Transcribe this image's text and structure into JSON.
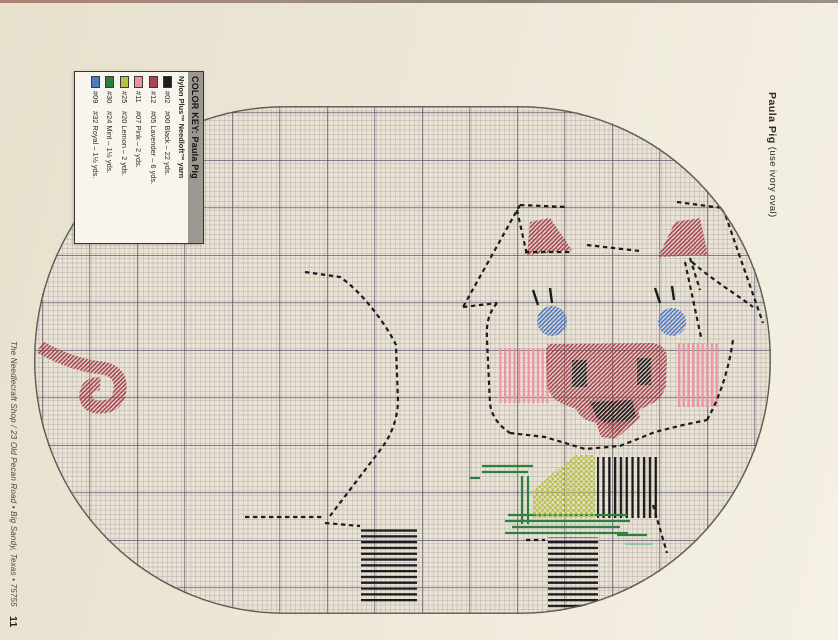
{
  "page": {
    "left_margin": {
      "text": "The Needlecraft Shop / 23 Old Pecan Road • Big Sandy, Texas • 75755",
      "page_number": "11"
    },
    "right_margin": {
      "title": "Paula Pig",
      "subtitle": " (use ivory oval)"
    }
  },
  "color_key": {
    "title_label": "COLOR KEY:",
    "title_name": " Paula Pig",
    "header": "Nylon Plus™ Needloft™ yarn",
    "rows": [
      {
        "swatch": "#1d1d1f",
        "nylon": "#02",
        "needloft": "#00 Black – 22 yds."
      },
      {
        "swatch": "#a84550",
        "nylon": "#12",
        "needloft": "#05 Lavender – 6 yds."
      },
      {
        "swatch": "#ee92a1",
        "nylon": "#11",
        "needloft": "#07 Pink – 2 yds."
      },
      {
        "swatch": "#b9c240",
        "nylon": "#25",
        "needloft": "#20 Lemon – 2 yds."
      },
      {
        "swatch": "#2e8040",
        "nylon": "#30",
        "needloft": "#24 Mint – 1½ yds."
      },
      {
        "swatch": "#4f79c4",
        "nylon": "#09",
        "needloft": "#32 Royal – 1½ yds."
      }
    ]
  },
  "palette": {
    "black": "#1c1c1e",
    "lav": "#a84550",
    "pink": "#ee92a1",
    "royal": "#4f79c4",
    "lemon": "#b9c240",
    "mint": "#2e8040",
    "mintLight": "#93c6a0",
    "paper": "#e9e3d3",
    "gridThin": "#a59aa6",
    "gridBold": "#48415a",
    "outline": "#5f5a52"
  },
  "chart": {
    "oval": {
      "x": 34,
      "y": 106,
      "width": 737,
      "height": 508,
      "rx": 250,
      "ry": 252,
      "cell": 4.75,
      "bold_every": 10
    },
    "patterns": [
      {
        "id": "pLav",
        "type": "diag",
        "color": "lav"
      },
      {
        "id": "pBlue",
        "type": "diag",
        "color": "royal"
      },
      {
        "id": "pBlackDiag",
        "type": "diag",
        "color": "black"
      },
      {
        "id": "pPinkV",
        "type": "vlines",
        "color": "pink",
        "gap": 4.7,
        "w": 2.2
      },
      {
        "id": "pLemon",
        "type": "check",
        "color": "lemon",
        "size": 2.6
      },
      {
        "id": "pBlackH",
        "type": "hlines",
        "color": "black",
        "gap": 5.8,
        "w": 2.3
      },
      {
        "id": "pBlackV",
        "type": "vlines",
        "color": "black",
        "gap": 5.8,
        "w": 2.3
      }
    ],
    "shapes": [
      {
        "kind": "curl",
        "name": "pig-tail",
        "pattern": "pLav",
        "width": 13,
        "d": "M6,241 Q38,259 68,262 Q88,265 86,284 Q84,301 66,301 Q50,301 52,287 Q54,277 66,278"
      },
      {
        "kind": "dash",
        "name": "pig-back-outline",
        "d": "M271,166 L306,171 C328,186 352,218 362,239 L364,296 C363,316 356,331 347,343 L296,410"
      },
      {
        "kind": "dash",
        "name": "pig-belly-outline",
        "d": "M211,411 L291,411 M291,417 L326,420"
      },
      {
        "kind": "rect",
        "name": "back-leg-stitches",
        "pattern": "pBlackH",
        "x": 327,
        "y": 421,
        "w": 56,
        "h": 76
      },
      {
        "kind": "rect",
        "name": "front-leg-stitches",
        "pattern": "pBlackH",
        "x": 514,
        "y": 431,
        "w": 50,
        "h": 74
      },
      {
        "kind": "rect",
        "name": "front-upper-leg-stitches",
        "pattern": "pBlackV",
        "x": 563,
        "y": 351,
        "w": 61,
        "h": 61
      },
      {
        "kind": "stroke",
        "name": "bow-ribbon-mint",
        "color": "mint",
        "width": 2.2,
        "d": "M448,360 L499,360 M448,366 L494,366 M436,372 L446,372 M488,370 L488,418 M494,370 L494,418 M474,409 L593,409 M471,415 L596,415 M478,421 L586,421 M471,427 L594,427 M583,429 L613,429"
      },
      {
        "kind": "stroke",
        "name": "bow-ribbon-mint-light",
        "color": "mintLight",
        "width": 2.2,
        "d": "M591,438 L619,438"
      },
      {
        "kind": "poly",
        "name": "bow-knot-lemon",
        "pattern": "pLemon",
        "points": "499,384 541,349 561,349 561,412 499,412"
      },
      {
        "kind": "rect",
        "name": "cheek-left-pink",
        "pattern": "pPinkV",
        "x": 464,
        "y": 242,
        "w": 52,
        "h": 55
      },
      {
        "kind": "rect",
        "name": "cheek-right-pink",
        "pattern": "pPinkV",
        "x": 643,
        "y": 237,
        "w": 43,
        "h": 64
      },
      {
        "kind": "path",
        "name": "snout",
        "pattern": "pLav",
        "d": "M514,238 L619,237 Q633,239 633,253 L632,279 Q629,293 615,299 L607,303 Q599,315 579,318 L564,317 Q547,315 542,303 L529,298 Q516,293 513,279 L512,251 Q512,239 514,238 Z"
      },
      {
        "kind": "rect",
        "name": "nostril-left",
        "pattern": "pBlackDiag",
        "x": 538,
        "y": 254,
        "w": 15,
        "h": 27
      },
      {
        "kind": "rect",
        "name": "nostril-right",
        "pattern": "pBlackDiag",
        "x": 603,
        "y": 252,
        "w": 14,
        "h": 27
      },
      {
        "kind": "poly",
        "name": "mouth-under",
        "pattern": "pLav",
        "points": "552,295 601,293 606,312 585,330 559,315"
      },
      {
        "kind": "poly",
        "name": "mouth",
        "pattern": "pBlackDiag",
        "points": "556,296 598,294 602,310 584,325 563,312"
      },
      {
        "kind": "poly",
        "name": "chin",
        "pattern": "pLav",
        "points": "562,317 595,315 582,333 567,331"
      },
      {
        "kind": "poly",
        "name": "ear-left-fill",
        "pattern": "pLav",
        "points": "493,149 538,144 516,112 496,116"
      },
      {
        "kind": "poly",
        "name": "ear-right-fill",
        "pattern": "pLav",
        "points": "624,151 674,149 666,112 641,116"
      },
      {
        "kind": "circle",
        "name": "eye-left",
        "pattern": "pBlue",
        "cx": 518,
        "cy": 215,
        "r": 15
      },
      {
        "kind": "circle",
        "name": "eye-right",
        "pattern": "pBlue",
        "cx": 638,
        "cy": 216,
        "r": 14
      },
      {
        "kind": "stroke",
        "name": "eyelashes",
        "color": "black",
        "width": 2.4,
        "d": "M499,184 L504,199 M516,182 L518,197 M621,182 L626,197 M638,180 L640,194"
      },
      {
        "kind": "dash",
        "name": "head-outline",
        "d": "M486,99 L533,101 M486,99 L429,201 M429,201 L463,197 M483,104 L493,149 M553,139 L606,145 M643,96 L689,102 M689,102 C699,131 715,177 729,217 M658,156 C681,176 705,190 719,201 M651,156 L667,231 M656,152 L666,184 M463,197 C451,211 453,226 453,234 L456,297 C457,311 467,321 476,327 M476,327 L511,331 L551,343 L586,340 L621,326 L649,319 L673,314 M673,314 C687,289 695,261 699,234"
      },
      {
        "kind": "dash",
        "name": "ear-left-stitch-row",
        "d": "M491,146 L536,146"
      },
      {
        "kind": "dash",
        "name": "misc-stitch-marks",
        "d": "M492,434 L511,434 M619,399 L633,447"
      }
    ]
  }
}
